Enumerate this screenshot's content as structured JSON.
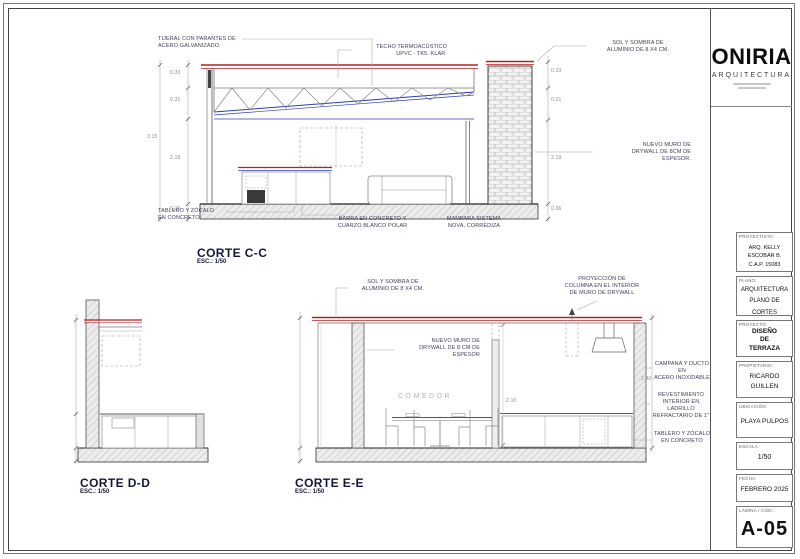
{
  "sections": {
    "cc": {
      "title": "CORTE C-C",
      "scale": "ESC.: 1/50",
      "ann": {
        "tijeral": "TIJERAL CON PARANTES DE\nACERO GALVANIZADO.",
        "techo": "TECHO TERMOACÚSTICO\nUPVC - TK5. KLAR.",
        "sol_sombra": "SOL Y SOMBRA DE\nALUMINIO DE 8 X4 CM.",
        "muro": "NUEVO MURO DE\nDRYWALL DE 8CM DE\nESPESOR.",
        "tablero": "TABLERO Y ZÓCALO\nEN CONCRETO",
        "barra": "BARRA EN CONCRETO Y\nCUARZO BLANCO POLAR",
        "mampara": "MAMPARA SISTEMA\nNOVA, CORREDIZA"
      },
      "dims": {
        "left": [
          "0.33",
          "0.31",
          "2.19",
          "0.36"
        ],
        "right": [
          "0.33",
          "0.31",
          "2.19",
          "0.36"
        ],
        "total": "3.15"
      }
    },
    "dd": {
      "title": "CORTE D-D",
      "scale": "ESC.: 1/50"
    },
    "ee": {
      "title": "CORTE E-E",
      "scale": "ESC.: 1/50",
      "ann": {
        "sol_sombra": "SOL Y SOMBRA DE\nALUMINIO DE 8 X4 CM.",
        "proyeccion": "PROYECCIÓN DE\nCOLUMNA EN EL INTERIOR\nDE MURO DE DRYWALL",
        "muro": "NUEVO MURO DE\nDRYWALL DE 8 CM DE\nESPESOR",
        "campana": "CAMPANA Y DUCTO EN\nACERO INOXIDABLE",
        "revestimiento": "REVESTIMIENTO\nINTERIOR EN LADRILLO\nREFRACTARIO DE 1\"",
        "tablero": "TABLERO Y ZÓCALO\nEN CONCRETO",
        "room": "COMEDOR"
      },
      "dims": {
        "a": "2.40",
        "b": "2.10"
      }
    }
  },
  "titleblock": {
    "logo": "ONIRIA",
    "logo_sub": "ARQUITECTURA",
    "fields": [
      {
        "label": "PROYECTISTA:",
        "value": "ARQ. KELLY ESCOBAR B.\nC.A.P.  15083"
      },
      {
        "label": "PLANO:",
        "value": "ARQUITECTURA\nPLANO DE CORTES"
      },
      {
        "label": "PROYECTO:",
        "value": "DISEÑO\nDE\nTERRAZA"
      },
      {
        "label": "PROPIETARIO:",
        "value": "RICARDO\nGUILLEN"
      },
      {
        "label": "UBICACIÓN:",
        "value": "PLAYA PULPOS"
      },
      {
        "label": "ESCALA:",
        "value": "1/50"
      },
      {
        "label": "FECHA:",
        "value": "FEBRERO 2025"
      },
      {
        "label": "LÁMINA / CÓD.:",
        "value": "A-05"
      }
    ]
  }
}
